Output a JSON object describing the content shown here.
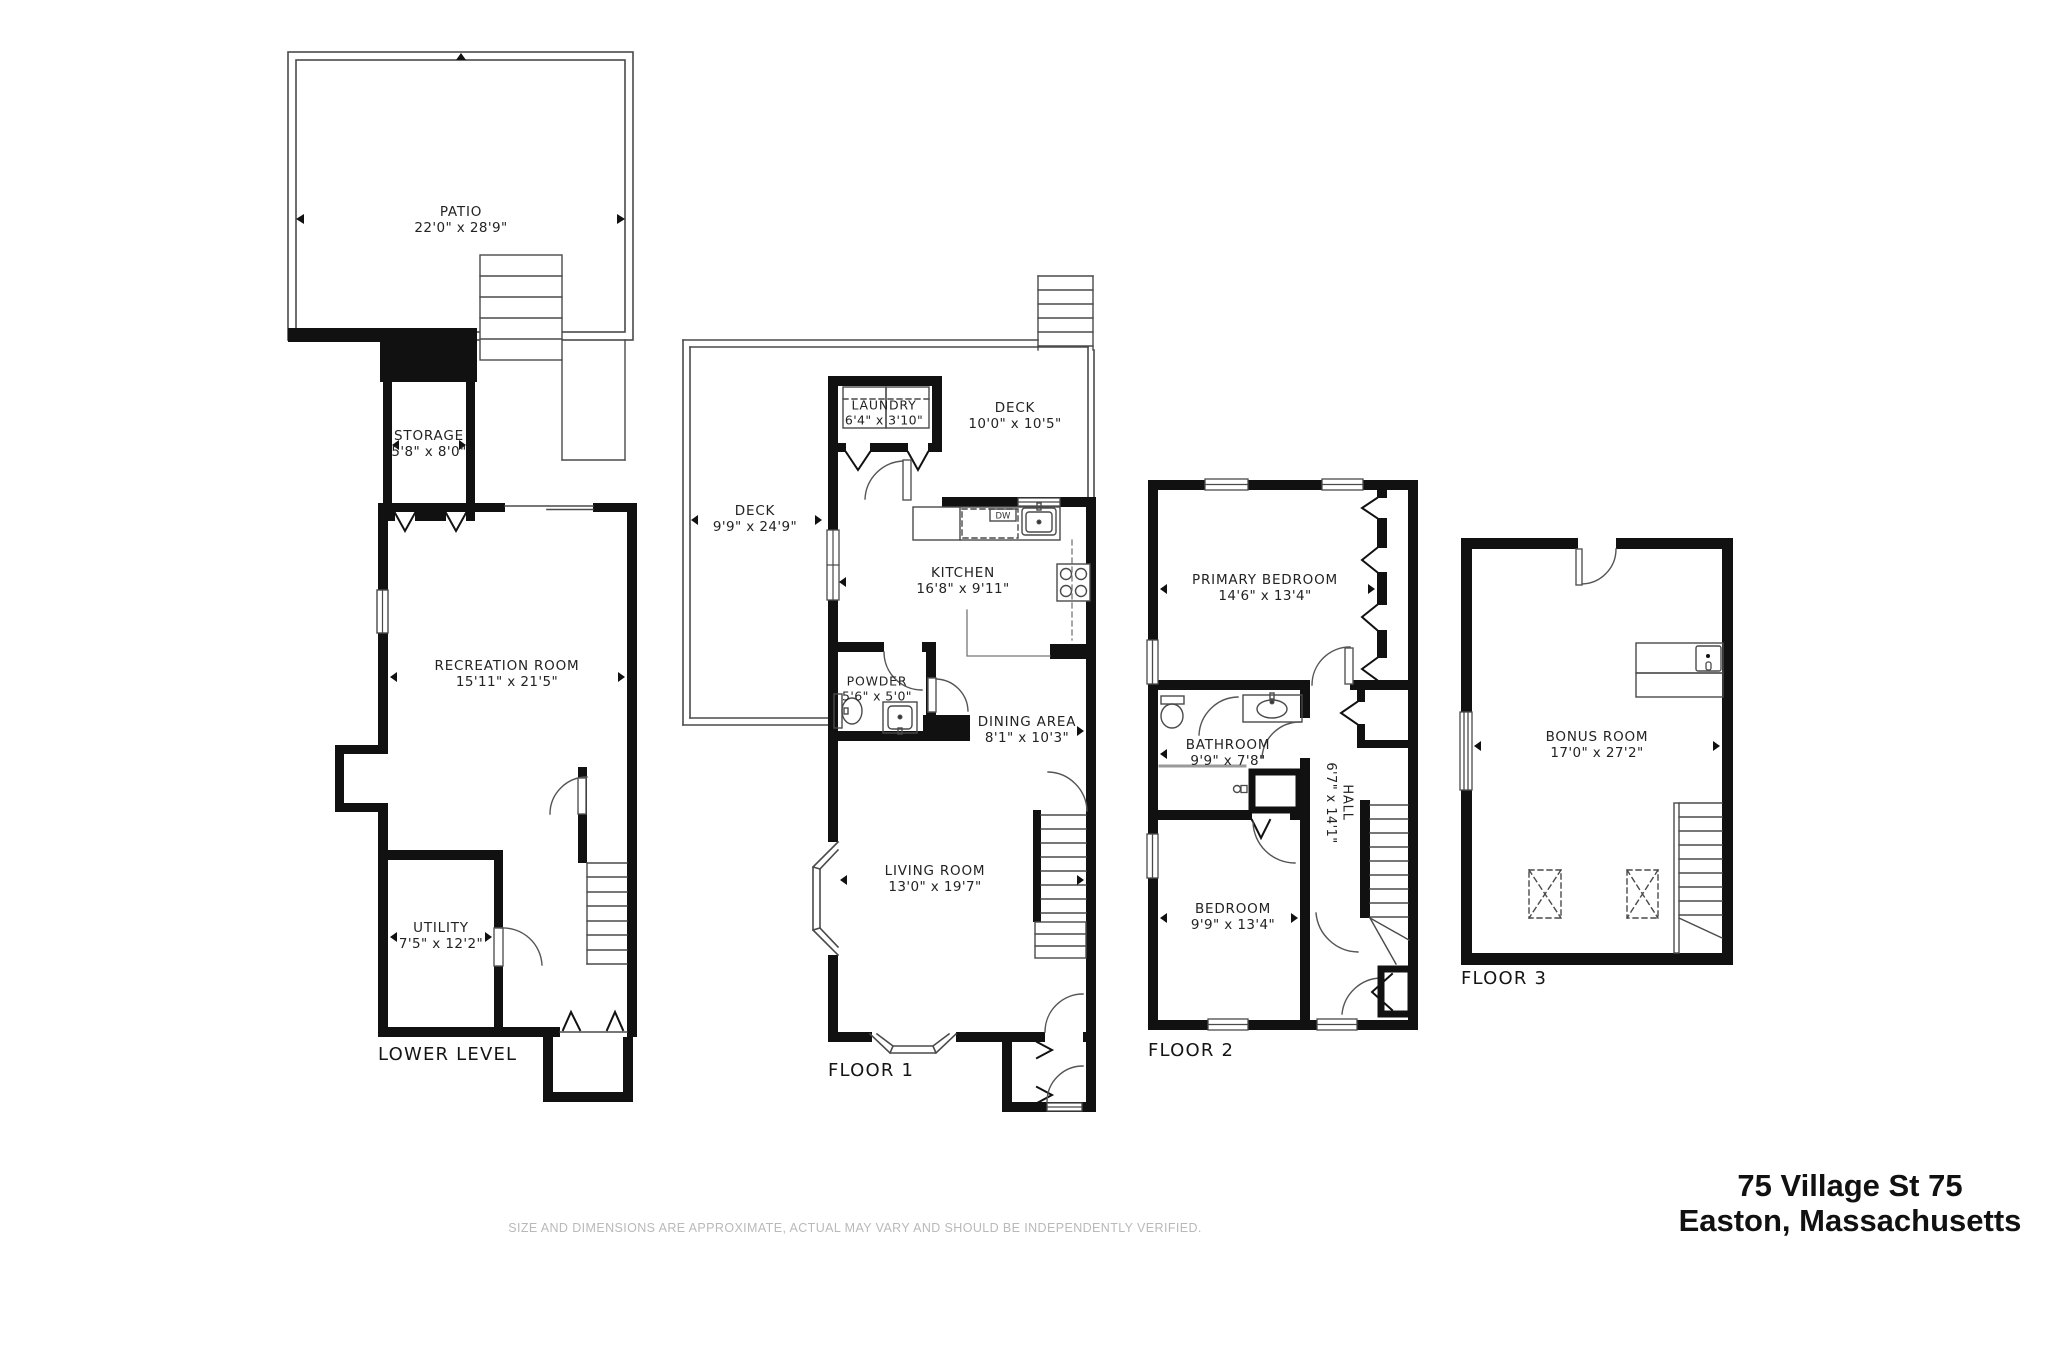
{
  "page": {
    "disclaimer": "SIZE AND DIMENSIONS ARE APPROXIMATE, ACTUAL MAY VARY AND SHOULD BE INDEPENDENTLY VERIFIED.",
    "address_line1": "75 Village St 75",
    "address_line2": "Easton, Massachusetts"
  },
  "floors": {
    "lower": {
      "label": "LOWER LEVEL",
      "rooms": {
        "patio": {
          "name": "PATIO",
          "dims": "22'0\" x 28'9\""
        },
        "storage": {
          "name": "STORAGE",
          "dims": "5'8\" x 8'0\""
        },
        "recreation": {
          "name": "RECREATION ROOM",
          "dims": "15'11\" x 21'5\""
        },
        "utility": {
          "name": "UTILITY",
          "dims": "7'5\" x 12'2\""
        }
      }
    },
    "floor1": {
      "label": "FLOOR 1",
      "rooms": {
        "deck_left": {
          "name": "DECK",
          "dims": "9'9\" x 24'9\""
        },
        "deck_right": {
          "name": "DECK",
          "dims": "10'0\" x 10'5\""
        },
        "laundry": {
          "name": "LAUNDRY",
          "dims": "6'4\" x 3'10\""
        },
        "kitchen": {
          "name": "KITCHEN",
          "dims": "16'8\" x 9'11\""
        },
        "powder": {
          "name": "POWDER",
          "dims": "5'6\" x 5'0\""
        },
        "dining": {
          "name": "DINING AREA",
          "dims": "8'1\" x 10'3\""
        },
        "living": {
          "name": "LIVING ROOM",
          "dims": "13'0\" x 19'7\""
        }
      },
      "appliances": {
        "dishwasher": "DW"
      }
    },
    "floor2": {
      "label": "FLOOR 2",
      "rooms": {
        "primary": {
          "name": "PRIMARY BEDROOM",
          "dims": "14'6\" x 13'4\""
        },
        "bathroom": {
          "name": "BATHROOM",
          "dims": "9'9\" x 7'8\""
        },
        "hall": {
          "name": "HALL",
          "dims": "6'7\" x 14'1\""
        },
        "bedroom": {
          "name": "BEDROOM",
          "dims": "9'9\" x 13'4\""
        }
      }
    },
    "floor3": {
      "label": "FLOOR 3",
      "rooms": {
        "bonus": {
          "name": "BONUS ROOM",
          "dims": "17'0\" x 27'2\""
        }
      }
    }
  }
}
